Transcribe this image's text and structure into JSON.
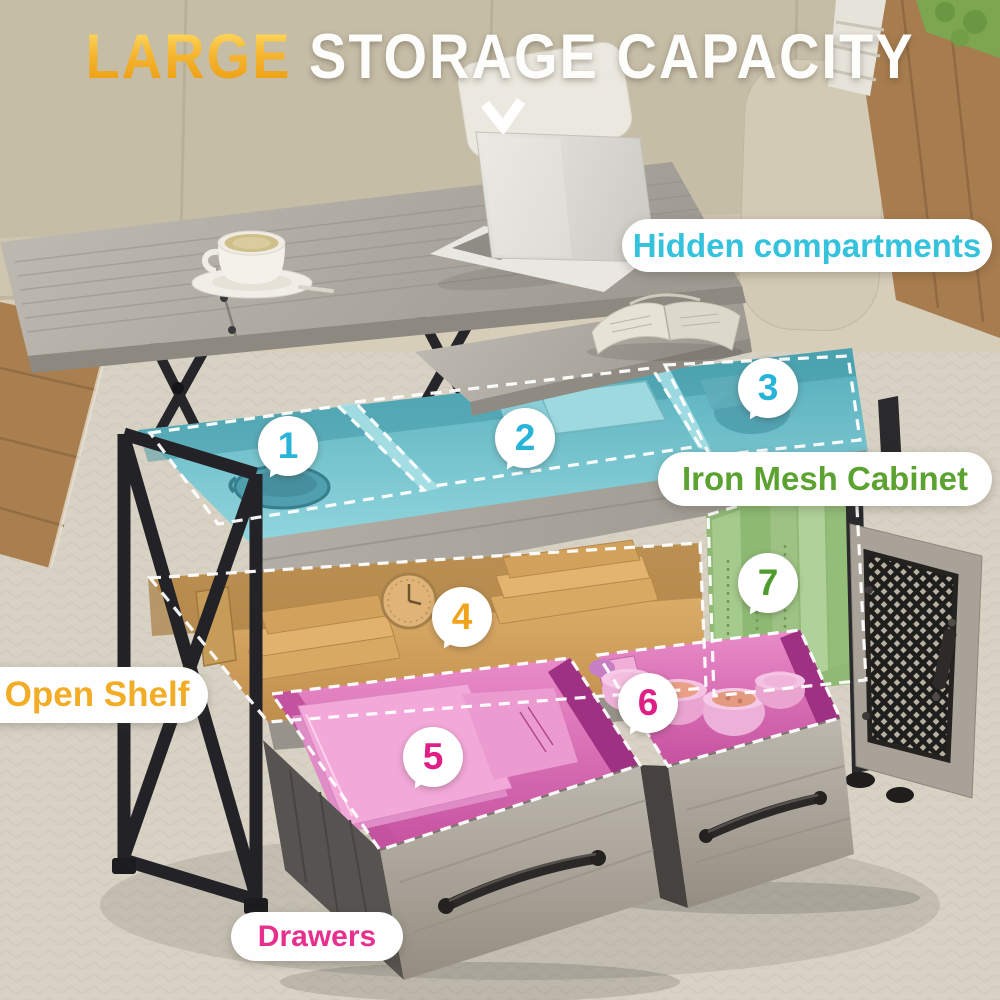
{
  "headline": {
    "highlight": "LARGE",
    "rest": " STORAGE CAPACITY"
  },
  "icons": {
    "pointer": "chevron-down"
  },
  "callouts": {
    "hidden_compartments": {
      "label": "Hidden compartments",
      "color": "#34c2dd"
    },
    "iron_mesh_cabinet": {
      "label": "Iron Mesh Cabinet",
      "color": "#5ba231"
    },
    "open_shelf": {
      "label": "Open Shelf",
      "color": "#f2ac26"
    },
    "drawers": {
      "label": "Drawers",
      "color": "#e72f8d"
    }
  },
  "markers": [
    {
      "num": "1",
      "color": "#27b4d8"
    },
    {
      "num": "2",
      "color": "#27b4d8"
    },
    {
      "num": "3",
      "color": "#27b4d8"
    },
    {
      "num": "4",
      "color": "#f0a31c"
    },
    {
      "num": "5",
      "color": "#e01f86"
    },
    {
      "num": "6",
      "color": "#e01f86"
    },
    {
      "num": "7",
      "color": "#4f9c2c"
    }
  ],
  "scene_colors": {
    "couch": "#cbc2ac",
    "rug": "#d8d2c5",
    "wood_floor": "#a87d4f",
    "table_wood_grey": "#aba79f",
    "metal_frame": "#26262a",
    "compartment_tint_cyan": "#6ec3cf",
    "shelf_tint_amber": "#d8a760",
    "cabinet_tint_green": "#96bd7b",
    "drawer_tint_pink": "#dc6fba",
    "dashed_outline": "#ffffff"
  }
}
